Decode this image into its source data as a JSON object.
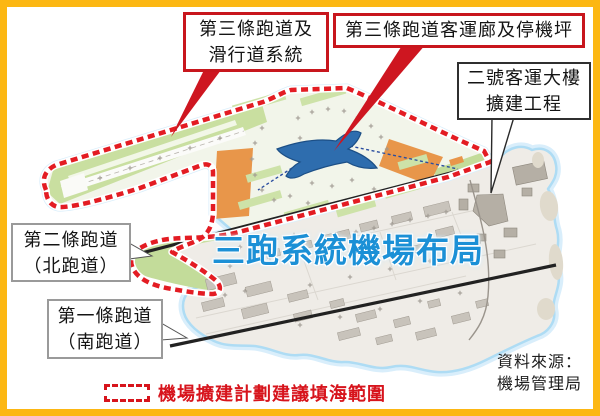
{
  "title": {
    "text": "三跑系統機場布局"
  },
  "callouts": {
    "third_runway_taxiway": {
      "line1": "第三條跑道及",
      "line2": "滑行道系統"
    },
    "third_runway_concourse": {
      "label": "第三條跑道客運廊及停機坪"
    },
    "terminal2_expansion": {
      "line1": "二號客運大樓",
      "line2": "擴建工程"
    },
    "second_runway": {
      "line1": "第二條跑道",
      "line2": "（北跑道）"
    },
    "first_runway": {
      "line1": "第一條跑道",
      "line2": "（南跑道）"
    }
  },
  "legend": {
    "label": "機場擴建計劃建議填海範圍"
  },
  "source": {
    "line1": "資料來源：",
    "line2": "機場管理局"
  },
  "map_features": {
    "reclamation_boundary": "airport expansion proposed reclamation outline (red dashed)",
    "third_runway": "new third runway strip (north reclamation)",
    "north_runway": "existing second runway (north)",
    "south_runway": "existing first runway (south)",
    "new_concourse": "third runway passenger concourse (blue X building)",
    "aprons": "new apron / works areas (orange)",
    "terminal2": "Terminal 2 expansion works area"
  },
  "colors": {
    "frame_border": "#fcb713",
    "boundary_red": "#e31c23",
    "callout_red": "#c8161d",
    "legend_red": "#d7141c",
    "apron_orange": "#e8964a",
    "reclamation_green": "#c9dfa0",
    "concourse_blue": "#2e6dae",
    "title_blue": "#1b90d6",
    "island_gray": "#efece7",
    "runway_black": "#222222",
    "water_glow": "#bfe4f6"
  }
}
